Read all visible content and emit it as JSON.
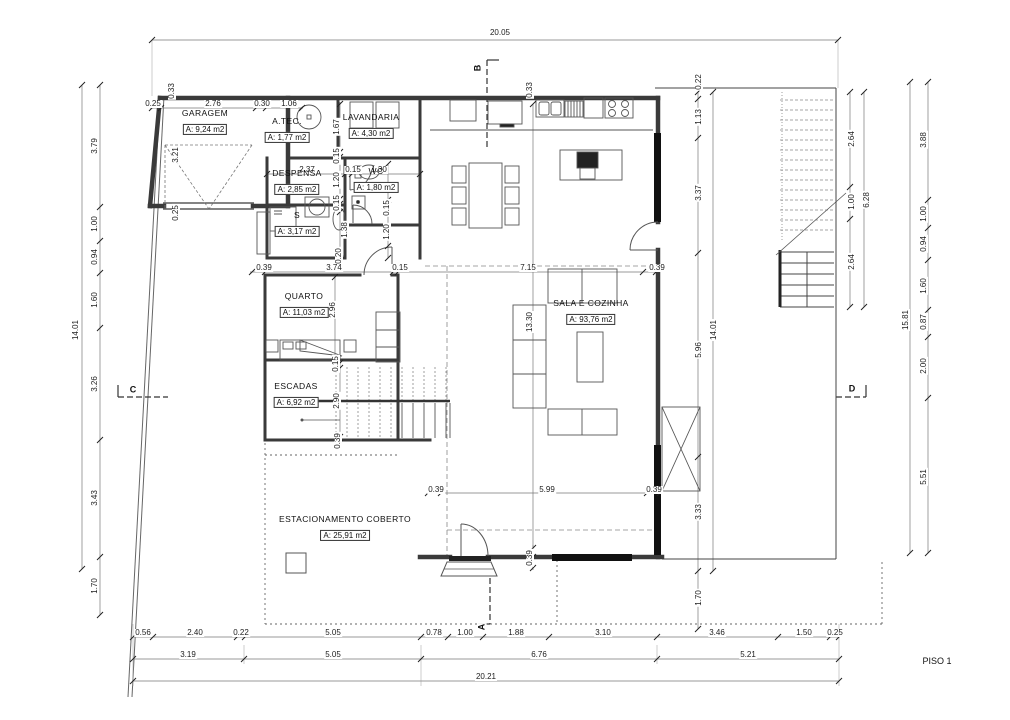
{
  "title": "PISO 1",
  "drawing": {
    "rooms": [
      {
        "name": "GARAGEM",
        "area": "A: 9,24 m2",
        "x": 205,
        "y": 123
      },
      {
        "name": "A.TEC.",
        "area": "A: 1,77 m2",
        "x": 287,
        "y": 131
      },
      {
        "name": "LAVANDARIA",
        "area": "A: 4,30 m2",
        "x": 371,
        "y": 127
      },
      {
        "name": "DESPENSA",
        "area": "A: 2,85 m2",
        "x": 297,
        "y": 183
      },
      {
        "name": "WC",
        "area": "A: 1,80 m2",
        "x": 376,
        "y": 181
      },
      {
        "name": "S",
        "area": "A: 3,17 m2",
        "x": 297,
        "y": 225
      },
      {
        "name": "QUARTO",
        "area": "A: 11,03 m2",
        "x": 304,
        "y": 306
      },
      {
        "name": "ESCADAS",
        "area": "A: 6,92 m2",
        "x": 296,
        "y": 396
      },
      {
        "name": "SALA E COZINHA",
        "area": "A: 93,76 m2",
        "x": 591,
        "y": 313
      },
      {
        "name": "ESTACIONAMENTO COBERTO",
        "area": "A: 25,91 m2",
        "x": 345,
        "y": 529
      }
    ],
    "markers": [
      {
        "t": "B",
        "x": 478,
        "y": 68,
        "r": -90
      },
      {
        "t": "A",
        "x": 482,
        "y": 627,
        "r": -90
      },
      {
        "t": "C",
        "x": 133,
        "y": 390,
        "r": 0
      },
      {
        "t": "D",
        "x": 852,
        "y": 389,
        "r": 0
      }
    ],
    "dims": [
      {
        "t": "20.05",
        "x": 500,
        "y": 33
      },
      {
        "t": "0.33",
        "x": 172,
        "y": 91,
        "r": -90
      },
      {
        "t": "0.25",
        "x": 153,
        "y": 104
      },
      {
        "t": "2.76",
        "x": 213,
        "y": 104
      },
      {
        "t": "0.30",
        "x": 262,
        "y": 104
      },
      {
        "t": "1.06",
        "x": 289,
        "y": 104
      },
      {
        "t": "0.33",
        "x": 530,
        "y": 90,
        "r": -90
      },
      {
        "t": "3.21",
        "x": 176,
        "y": 155,
        "r": -90
      },
      {
        "t": "0.25",
        "x": 176,
        "y": 213,
        "r": -90
      },
      {
        "t": "1.67",
        "x": 337,
        "y": 127,
        "r": -90
      },
      {
        "t": "0.15",
        "x": 337,
        "y": 156,
        "r": -90
      },
      {
        "t": "1.20",
        "x": 337,
        "y": 180,
        "r": -90
      },
      {
        "t": "0.15",
        "x": 337,
        "y": 203,
        "r": -90
      },
      {
        "t": "1.38",
        "x": 345,
        "y": 230,
        "r": -90
      },
      {
        "t": "0.20",
        "x": 339,
        "y": 256,
        "r": -90
      },
      {
        "t": "2.37",
        "x": 307,
        "y": 170
      },
      {
        "t": "0.15",
        "x": 353,
        "y": 170
      },
      {
        "t": "1.30",
        "x": 379,
        "y": 170
      },
      {
        "t": "0.15",
        "x": 387,
        "y": 208,
        "r": -90
      },
      {
        "t": "1.20",
        "x": 387,
        "y": 232,
        "r": -90
      },
      {
        "t": "0.39",
        "x": 264,
        "y": 268
      },
      {
        "t": "3.74",
        "x": 334,
        "y": 268
      },
      {
        "t": "0.15",
        "x": 400,
        "y": 268
      },
      {
        "t": "7.15",
        "x": 528,
        "y": 268
      },
      {
        "t": "0.39",
        "x": 657,
        "y": 268
      },
      {
        "t": "2.96",
        "x": 333,
        "y": 310,
        "r": -90
      },
      {
        "t": "13.30",
        "x": 530,
        "y": 322,
        "r": -90
      },
      {
        "t": "0.15",
        "x": 336,
        "y": 364,
        "r": -90
      },
      {
        "t": "2.90",
        "x": 337,
        "y": 401,
        "r": -90
      },
      {
        "t": "0.39",
        "x": 338,
        "y": 441,
        "r": -90
      },
      {
        "t": "0.39",
        "x": 436,
        "y": 490
      },
      {
        "t": "5.99",
        "x": 547,
        "y": 490
      },
      {
        "t": "0.39",
        "x": 654,
        "y": 490
      },
      {
        "t": "0.39",
        "x": 530,
        "y": 558,
        "r": -90
      },
      {
        "t": "14.01",
        "x": 76,
        "y": 330,
        "r": -90
      },
      {
        "t": "3.79",
        "x": 95,
        "y": 146,
        "r": -90
      },
      {
        "t": "1.00",
        "x": 95,
        "y": 224,
        "r": -90
      },
      {
        "t": "0.94",
        "x": 95,
        "y": 257,
        "r": -90
      },
      {
        "t": "1.60",
        "x": 95,
        "y": 300,
        "r": -90
      },
      {
        "t": "3.26",
        "x": 95,
        "y": 384,
        "r": -90
      },
      {
        "t": "3.43",
        "x": 95,
        "y": 498,
        "r": -90
      },
      {
        "t": "1.70",
        "x": 95,
        "y": 586,
        "r": -90
      },
      {
        "t": "0.22",
        "x": 699,
        "y": 82,
        "r": -90
      },
      {
        "t": "1.13",
        "x": 699,
        "y": 117,
        "r": -90
      },
      {
        "t": "3.37",
        "x": 699,
        "y": 193,
        "r": -90
      },
      {
        "t": "5.96",
        "x": 699,
        "y": 350,
        "r": -90
      },
      {
        "t": "3.33",
        "x": 699,
        "y": 512,
        "r": -90
      },
      {
        "t": "1.70",
        "x": 699,
        "y": 598,
        "r": -90
      },
      {
        "t": "14.01",
        "x": 714,
        "y": 330,
        "r": -90
      },
      {
        "t": "2.64",
        "x": 852,
        "y": 139,
        "r": -90
      },
      {
        "t": "1.00",
        "x": 852,
        "y": 202,
        "r": -90
      },
      {
        "t": "2.64",
        "x": 852,
        "y": 262,
        "r": -90
      },
      {
        "t": "6.28",
        "x": 867,
        "y": 200,
        "r": -90
      },
      {
        "t": "15.81",
        "x": 906,
        "y": 320,
        "r": -90
      },
      {
        "t": "3.88",
        "x": 924,
        "y": 140,
        "r": -90
      },
      {
        "t": "1.00",
        "x": 924,
        "y": 214,
        "r": -90
      },
      {
        "t": "0.94",
        "x": 924,
        "y": 244,
        "r": -90
      },
      {
        "t": "1.60",
        "x": 924,
        "y": 286,
        "r": -90
      },
      {
        "t": "0.87",
        "x": 924,
        "y": 322,
        "r": -90
      },
      {
        "t": "2.00",
        "x": 924,
        "y": 366,
        "r": -90
      },
      {
        "t": "5.51",
        "x": 924,
        "y": 477,
        "r": -90
      },
      {
        "t": "0.56",
        "x": 143,
        "y": 633
      },
      {
        "t": "2.40",
        "x": 195,
        "y": 633
      },
      {
        "t": "0.22",
        "x": 241,
        "y": 633
      },
      {
        "t": "5.05",
        "x": 333,
        "y": 633
      },
      {
        "t": "0.78",
        "x": 434,
        "y": 633
      },
      {
        "t": "1.00",
        "x": 465,
        "y": 633
      },
      {
        "t": "1.88",
        "x": 516,
        "y": 633
      },
      {
        "t": "3.10",
        "x": 603,
        "y": 633
      },
      {
        "t": "3.46",
        "x": 717,
        "y": 633
      },
      {
        "t": "1.50",
        "x": 804,
        "y": 633
      },
      {
        "t": "0.25",
        "x": 835,
        "y": 633
      },
      {
        "t": "3.19",
        "x": 188,
        "y": 655
      },
      {
        "t": "5.05",
        "x": 333,
        "y": 655
      },
      {
        "t": "6.76",
        "x": 539,
        "y": 655
      },
      {
        "t": "5.21",
        "x": 748,
        "y": 655
      },
      {
        "t": "20.21",
        "x": 486,
        "y": 677
      }
    ]
  }
}
